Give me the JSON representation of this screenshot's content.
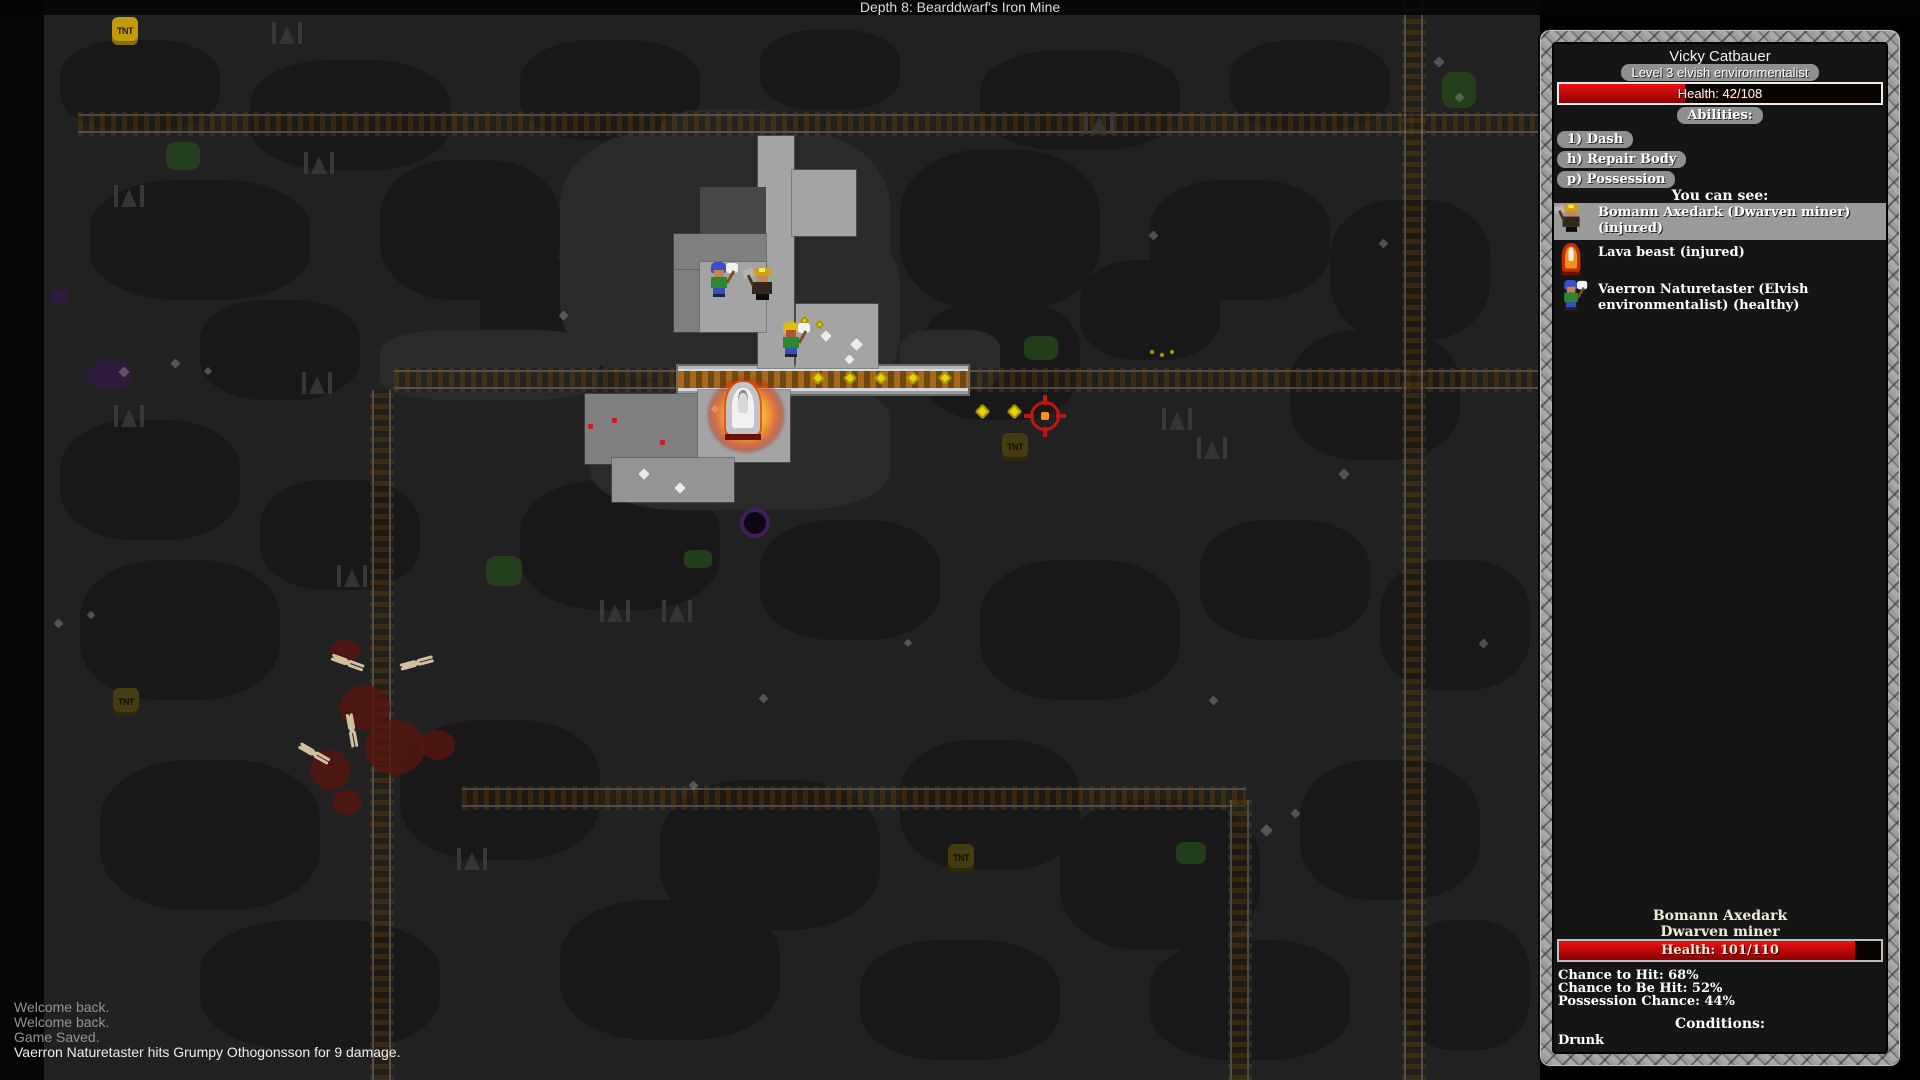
{
  "header": {
    "title": "Depth 8: Bearddwarf's Iron Mine"
  },
  "log": {
    "messages": [
      {
        "text": "Welcome back.",
        "muted": true
      },
      {
        "text": "Welcome back.",
        "muted": true
      },
      {
        "text": "Game Saved.",
        "muted": true
      },
      {
        "text": "Vaerron Naturetaster hits Grumpy Othogonsson for 9 damage.",
        "muted": false
      }
    ]
  },
  "sidebar": {
    "player": {
      "name": "Vicky Catbauer",
      "class_label": "Level 3 elvish environmentalist",
      "health_label": "Health: 42/108",
      "health_current": 42,
      "health_max": 108,
      "health_pct": 39
    },
    "abilities_header": "Abilities:",
    "abilities": [
      "1) Dash",
      "h) Repair Body",
      "p) Possession"
    ],
    "see_header": "You can see:",
    "seen": [
      {
        "icon": "dwarf-miner-icon",
        "selected": true,
        "lines": [
          "Bomann Axedark (Dwarven miner)",
          "(injured)"
        ]
      },
      {
        "icon": "lava-beast-icon",
        "selected": false,
        "lines": [
          "Lava beast (injured)"
        ]
      },
      {
        "icon": "elf-icon",
        "selected": false,
        "lines": [
          "Vaerron Naturetaster (Elvish",
          "environmentalist) (healthy)"
        ]
      }
    ],
    "target": {
      "name": "Bomann Axedark",
      "class_label": "Dwarven miner",
      "health_label": "Health: 101/110",
      "health_current": 101,
      "health_max": 110,
      "health_pct": 92,
      "stats": [
        "Chance to Hit: 68%",
        "Chance to Be Hit: 52%",
        "Possession Chance: 44%"
      ],
      "conditions_header": "Conditions:",
      "conditions": [
        "Drunk"
      ]
    }
  },
  "colors": {
    "health_red": "#cc0000",
    "coin_gold": "#e8d40c",
    "fire_orange": "#ff9c1c",
    "reticle_red": "#c41414",
    "chip_gray": "#8f8f8f",
    "frame_stone": "#9d9d9d"
  },
  "map": {
    "blobs": [
      [
        60,
        40,
        160,
        90
      ],
      [
        250,
        60,
        200,
        110
      ],
      [
        520,
        40,
        180,
        100
      ],
      [
        760,
        30,
        140,
        80
      ],
      [
        980,
        50,
        200,
        100
      ],
      [
        1230,
        40,
        160,
        90
      ],
      [
        90,
        180,
        220,
        120
      ],
      [
        380,
        160,
        180,
        140
      ],
      [
        900,
        150,
        200,
        160
      ],
      [
        1150,
        180,
        180,
        120
      ],
      [
        1330,
        200,
        160,
        140
      ],
      [
        60,
        420,
        180,
        120
      ],
      [
        200,
        300,
        160,
        100
      ],
      [
        480,
        260,
        140,
        120
      ],
      [
        920,
        300,
        160,
        120
      ],
      [
        1080,
        260,
        140,
        100
      ],
      [
        1290,
        330,
        170,
        130
      ],
      [
        80,
        560,
        200,
        140
      ],
      [
        260,
        480,
        160,
        110
      ],
      [
        520,
        480,
        200,
        130
      ],
      [
        760,
        520,
        180,
        120
      ],
      [
        980,
        560,
        200,
        140
      ],
      [
        1200,
        520,
        170,
        120
      ],
      [
        1380,
        560,
        150,
        130
      ],
      [
        100,
        760,
        220,
        150
      ],
      [
        400,
        720,
        200,
        140
      ],
      [
        660,
        780,
        220,
        150
      ],
      [
        900,
        740,
        180,
        130
      ],
      [
        1060,
        800,
        200,
        150
      ],
      [
        1300,
        760,
        180,
        140
      ],
      [
        200,
        920,
        240,
        130
      ],
      [
        560,
        900,
        220,
        140
      ],
      [
        860,
        940,
        200,
        120
      ],
      [
        1150,
        940,
        200,
        120
      ],
      [
        1400,
        920,
        130,
        130
      ]
    ],
    "walls": [
      [
        560,
        130,
        330,
        250
      ],
      [
        590,
        380,
        300,
        130
      ],
      [
        660,
        110,
        130,
        70
      ],
      [
        380,
        330,
        220,
        70
      ],
      [
        900,
        330,
        100,
        60
      ],
      [
        840,
        250,
        60,
        120
      ]
    ],
    "moss": [
      [
        166,
        142,
        34,
        28
      ],
      [
        486,
        556,
        36,
        30
      ],
      [
        1024,
        336,
        34,
        24
      ],
      [
        1442,
        72,
        34,
        36
      ],
      [
        1176,
        842,
        30,
        22
      ],
      [
        684,
        550,
        28,
        18
      ]
    ],
    "purple": [
      [
        88,
        360,
        44,
        30
      ],
      [
        50,
        290,
        20,
        14
      ]
    ],
    "purple_ring": {
      "x": 740,
      "y": 508
    },
    "tracks": [
      {
        "dir": "h",
        "x": 78,
        "y": 112,
        "len": 1462,
        "bright": false
      },
      {
        "dir": "h",
        "x": 394,
        "y": 368,
        "len": 290,
        "bright": false
      },
      {
        "dir": "h",
        "x": 966,
        "y": 368,
        "len": 576,
        "bright": false
      },
      {
        "dir": "h",
        "x": 462,
        "y": 786,
        "len": 784,
        "bright": false
      },
      {
        "dir": "v",
        "x": 370,
        "y": 390,
        "len": 690,
        "bright": false
      },
      {
        "dir": "v",
        "x": 1402,
        "y": 0,
        "len": 1080,
        "bright": false
      },
      {
        "dir": "v",
        "x": 1228,
        "y": 800,
        "len": 280,
        "bright": false
      },
      {
        "dir": "h",
        "x": 678,
        "y": 366,
        "len": 290,
        "bright": true
      }
    ],
    "props": [
      [
        270,
        22
      ],
      [
        112,
        185
      ],
      [
        302,
        152
      ],
      [
        112,
        405
      ],
      [
        300,
        372
      ],
      [
        335,
        565
      ],
      [
        598,
        600
      ],
      [
        660,
        600
      ],
      [
        1160,
        408
      ],
      [
        1195,
        437
      ],
      [
        455,
        848
      ],
      [
        1082,
        112
      ]
    ],
    "blood": [
      [
        340,
        685,
        50,
        45
      ],
      [
        365,
        720,
        60,
        55
      ],
      [
        310,
        750,
        40,
        40
      ],
      [
        420,
        730,
        35,
        30
      ],
      [
        330,
        640,
        30,
        22
      ],
      [
        332,
        790,
        30,
        25
      ]
    ],
    "bones": [
      [
        333,
        658,
        20
      ],
      [
        402,
        662,
        -15
      ],
      [
        342,
        722,
        80
      ],
      [
        300,
        748,
        30
      ]
    ],
    "reddots": [
      [
        612,
        418
      ],
      [
        660,
        440
      ],
      [
        588,
        424
      ]
    ],
    "sparkles": [
      [
        120,
        368,
        8,
        0
      ],
      [
        172,
        360,
        7,
        0
      ],
      [
        205,
        368,
        6,
        0
      ],
      [
        560,
        312,
        7,
        0
      ],
      [
        1150,
        232,
        7,
        0
      ],
      [
        1262,
        826,
        9,
        0
      ],
      [
        1292,
        810,
        7,
        0
      ],
      [
        1435,
        58,
        8,
        0
      ],
      [
        1456,
        94,
        7,
        0
      ],
      [
        1340,
        470,
        8,
        0
      ],
      [
        1210,
        697,
        7,
        0
      ],
      [
        760,
        695,
        7,
        0
      ],
      [
        690,
        782,
        7,
        0
      ],
      [
        905,
        640,
        6,
        0
      ],
      [
        1480,
        640,
        7,
        0
      ],
      [
        55,
        620,
        7,
        0
      ],
      [
        88,
        612,
        6,
        0
      ],
      [
        1380,
        240,
        7,
        0
      ],
      [
        822,
        332,
        8,
        1
      ],
      [
        852,
        340,
        9,
        1
      ],
      [
        846,
        356,
        7,
        1
      ],
      [
        640,
        470,
        8,
        1
      ],
      [
        676,
        484,
        8,
        1
      ],
      [
        712,
        406,
        6,
        1
      ]
    ],
    "floors": [
      [
        758,
        136,
        36,
        232,
        "a"
      ],
      [
        792,
        170,
        64,
        66,
        "a"
      ],
      [
        700,
        187,
        66,
        48,
        "d"
      ],
      [
        674,
        234,
        92,
        36,
        "b"
      ],
      [
        674,
        270,
        28,
        62,
        "b"
      ],
      [
        700,
        262,
        66,
        70,
        "a"
      ],
      [
        796,
        304,
        82,
        64,
        "a"
      ],
      [
        585,
        394,
        118,
        70,
        "b"
      ],
      [
        698,
        390,
        92,
        72,
        "a"
      ],
      [
        612,
        458,
        122,
        44,
        "c"
      ]
    ],
    "coins": [
      [
        813,
        373,
        10
      ],
      [
        845,
        373,
        10
      ],
      [
        876,
        373,
        10
      ],
      [
        908,
        373,
        10
      ],
      [
        940,
        373,
        10
      ],
      [
        977,
        406,
        11
      ],
      [
        1009,
        406,
        11
      ],
      [
        801,
        317,
        7
      ],
      [
        816,
        321,
        7
      ],
      [
        1150,
        350,
        4
      ],
      [
        1160,
        353,
        4
      ],
      [
        1170,
        350,
        4
      ]
    ],
    "tnt": [
      [
        112,
        17,
        "bright"
      ],
      [
        1002,
        433,
        "dim"
      ],
      [
        948,
        844,
        "dim"
      ],
      [
        113,
        688,
        "dim"
      ]
    ],
    "fire": {
      "x": 696,
      "y": 366,
      "w": 100,
      "h": 98
    },
    "lava_beast": {
      "x": 723,
      "y": 382,
      "w": 40,
      "h": 58
    },
    "entities": [
      {
        "type": "elf",
        "variant": "blue",
        "x": 706,
        "y": 262,
        "label": "vaerron-naturetaster"
      },
      {
        "type": "dwarf",
        "variant": "",
        "x": 749,
        "y": 266,
        "label": "grumpy-othogonsson"
      },
      {
        "type": "elf",
        "variant": "yellow",
        "x": 778,
        "y": 322,
        "label": "vicky-catbauer"
      }
    ],
    "reticle": {
      "x": 1025,
      "y": 396
    }
  }
}
